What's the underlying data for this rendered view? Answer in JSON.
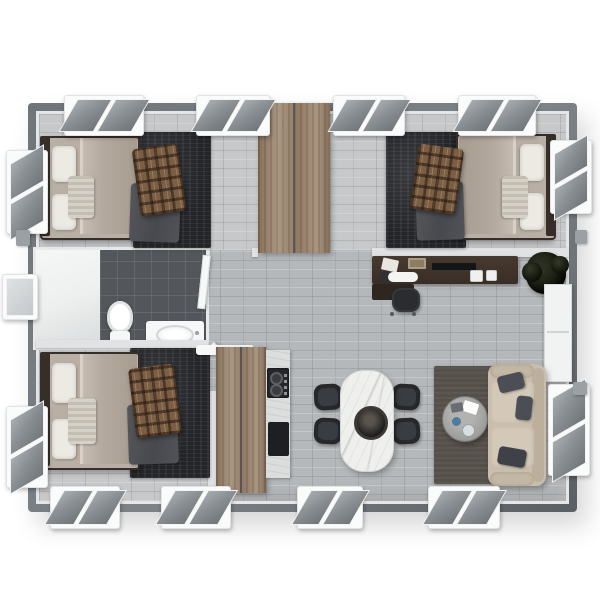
{
  "scene": {
    "title": "Top-down 3D floor plan of a rectangular modular home",
    "view": "overhead render, no visible text",
    "background": "#ffffff"
  },
  "palette": {
    "wall": "#70757a",
    "wall_edge": "#5a5f63",
    "interior_trim": "#e4e6e7",
    "floor_main": "#b5b8ba",
    "floor_bedroom": "#c6c8c9",
    "tile": "#53575c",
    "shower": "#eef0f0",
    "wood": "#9f8a73",
    "bed_frame": "#362e28",
    "mattress": "#b9afa4",
    "pillow": "#edeae4",
    "blanket": "#b3a89d",
    "throw": "#d6d1c7",
    "rug_dark": "#242529",
    "drape": "#47494e",
    "plaid_base": "#7b5e43",
    "desk": "#392e26",
    "chair_black": "#26282b",
    "office_chair": "#2a2c2f",
    "marble": "#eff0ee",
    "bowl": "#2e2a27",
    "rug_living": "#56504a",
    "coffee_table": "#9d9e9c",
    "sofa_base": "#c9bead",
    "sofa_cushion": "#d4c9b8",
    "sofa_back": "#bcb09d",
    "sofa_pillow": "#4b4f55",
    "plant": "#171a0f",
    "glass_light": "#a7acb0",
    "glass_dark": "#70757a",
    "window_frame": "#fafbfb",
    "partition": "#e0e2e3",
    "cabinet_white": "#f1f2f2",
    "counter": "#dcdddd"
  },
  "rooms": [
    {
      "id": "bedroom-1",
      "label": "Bedroom 1 (top left): double bed, plaid throw, dark area rug",
      "furniture": [
        "double bed",
        "two pillows",
        "knit throw",
        "gray drape",
        "plaid blanket",
        "dark rug"
      ]
    },
    {
      "id": "bedroom-2",
      "label": "Bedroom 2 (top right, mirrored): double bed, plaid throw, dark area rug",
      "furniture": [
        "double bed",
        "two pillows",
        "knit throw",
        "gray drape",
        "plaid blanket",
        "dark rug"
      ]
    },
    {
      "id": "wardrobe",
      "label": "Central double-door wardrobe between bedrooms",
      "furniture": [
        "wood wardrobe"
      ]
    },
    {
      "id": "bathroom",
      "label": "Bathroom: shower, toilet, vanity sink on dark tile",
      "furniture": [
        "shower stall",
        "toilet",
        "vanity with sink",
        "door"
      ]
    },
    {
      "id": "bedroom-3",
      "label": "Bedroom 3 (bottom left): double bed, plaid throw, dark area rug",
      "furniture": [
        "double bed",
        "two pillows",
        "knit throw",
        "gray drape",
        "plaid blanket",
        "dark rug"
      ]
    },
    {
      "id": "kitchen",
      "label": "Kitchen: wood pantry, counter with cooktop and oven",
      "furniture": [
        "pantry cabinet",
        "counter",
        "cooktop",
        "oven",
        "shelf"
      ]
    },
    {
      "id": "office",
      "label": "Work corner: dark desk, office chair, plant, white cabinet",
      "furniture": [
        "desk",
        "office chair",
        "monitor",
        "keyboard",
        "papers",
        "books",
        "mugs",
        "plant",
        "white cabinet"
      ]
    },
    {
      "id": "dining",
      "label": "Dining area: marble table with four black chairs",
      "furniture": [
        "marble dining table",
        "centerpiece bowl",
        "4 black chairs"
      ]
    },
    {
      "id": "living",
      "label": "Living area: beige sofa, round coffee table on dark rug",
      "furniture": [
        "two-seat sofa",
        "dark throw pillows",
        "round coffee table",
        "cup and papers",
        "area rug"
      ]
    }
  ],
  "windows": {
    "top": 4,
    "bottom": 4,
    "left": 3,
    "right": 2,
    "style": "white-framed tilted awning panes"
  }
}
